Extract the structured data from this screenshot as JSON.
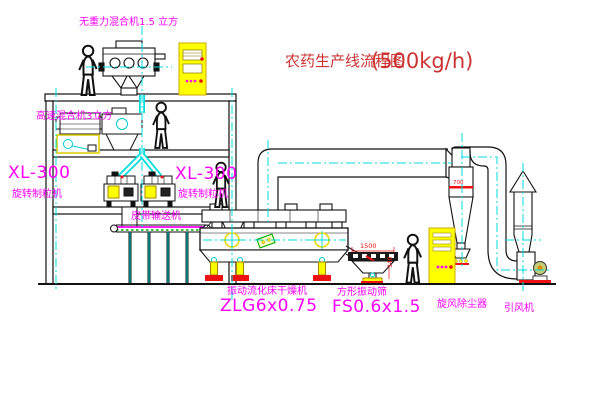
{
  "title": {
    "name": "农药生产线流程图",
    "capacity": "(500kg/h)"
  },
  "equipment_labels": {
    "top_mixer": "无重力混合机1.5 立方",
    "second_mixer": "高速混合机3立方",
    "granulator_left_model": "XL-300",
    "granulator_left_name": "旋转制粒机",
    "granulator_right_model": "XL-300",
    "granulator_right_name": "旋转制粒机",
    "belt_conveyor": "皮带输送机",
    "dryer_name": "振动流化床干燥机",
    "dryer_model": "ZLG6x0.75",
    "sieve_name": "方形振动筛",
    "sieve_model": "FS0.6x1.5",
    "cyclone_name": "旋风除尘器",
    "fan_name": "引风机"
  },
  "dimension_annotations": {
    "sieve_length": "1500",
    "sieve_height": "340",
    "cyclone_note": "700"
  },
  "colors": {
    "label_magenta": "#FF00FF",
    "title_red": "#CC3333",
    "line_black": "#111111",
    "centerline_cyan": "#00DDDD",
    "accent_yellow": "#FFFF00",
    "accent_red": "#EE1111",
    "conveyor_green": "#00AA00"
  }
}
